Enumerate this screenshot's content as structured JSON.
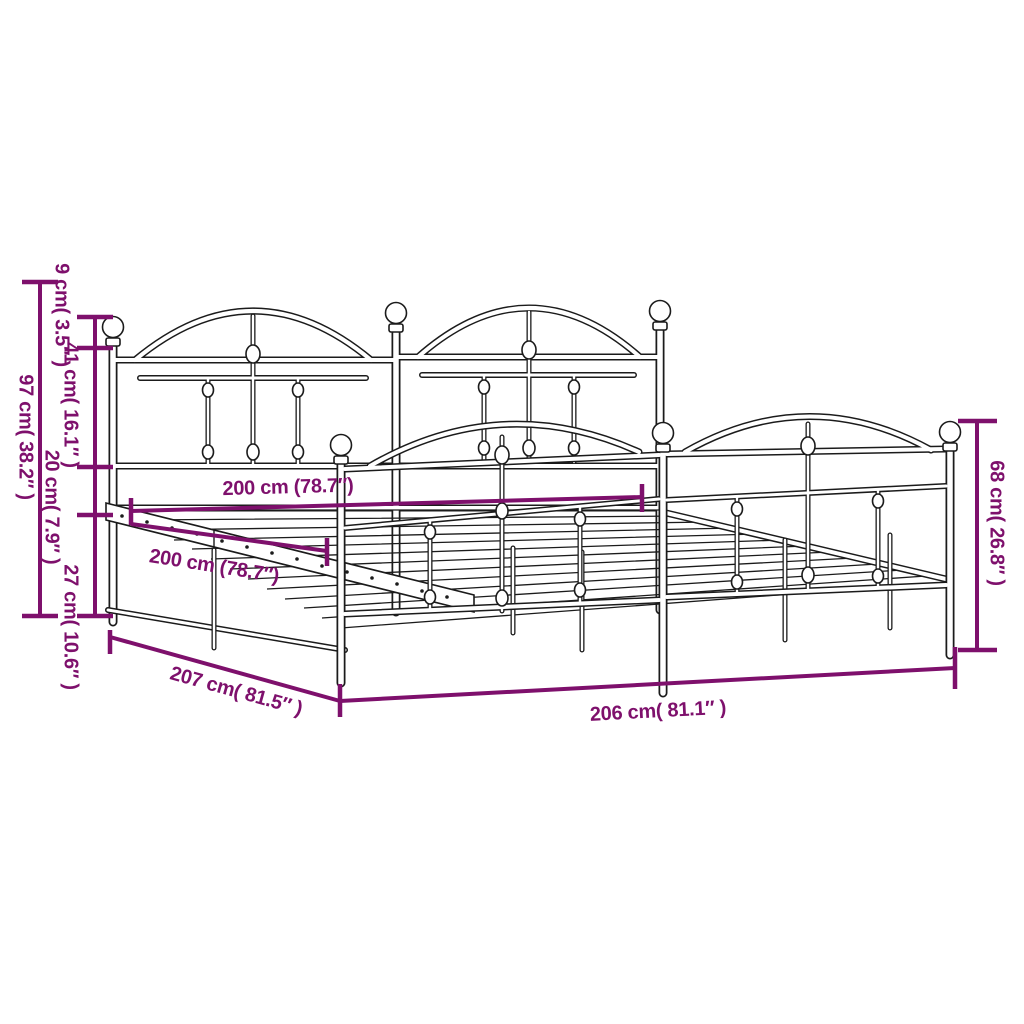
{
  "title": "Metal bed frame with headboard and footboard — dimension diagram",
  "colors": {
    "dimension": "#7E106C",
    "line": "#1b1b1b",
    "background": "#ffffff"
  },
  "dimensions": {
    "finial": {
      "cm": 9,
      "inch": 3.5,
      "label": "9 cm( 3.5″ )"
    },
    "panel": {
      "cm": 41,
      "inch": 16.1,
      "label": "41 cm( 16.1″ )"
    },
    "rail": {
      "cm": 20,
      "inch": 7.9,
      "label": "20 cm( 7.9″ )"
    },
    "clearance": {
      "cm": 27,
      "inch": 10.6,
      "label": "27 cm( 10.6″ )"
    },
    "headboard_height": {
      "cm": 97,
      "inch": 38.2,
      "label": "97 cm( 38.2″ )"
    },
    "footboard_height": {
      "cm": 68,
      "inch": 26.8,
      "label": "68 cm( 26.8″ )"
    },
    "inner_length": {
      "cm": 200,
      "inch": 78.7,
      "label": "200 cm (78.7″)"
    },
    "slat_rail_length": {
      "cm": 200,
      "inch": 78.7,
      "label": "200 cm (78.7″)"
    },
    "total_width_left": {
      "cm": 207,
      "inch": 81.5,
      "label": "207 cm( 81.5″ )"
    },
    "total_length_front": {
      "cm": 206,
      "inch": 81.1,
      "label": "206 cm( 81.1″ )"
    }
  }
}
